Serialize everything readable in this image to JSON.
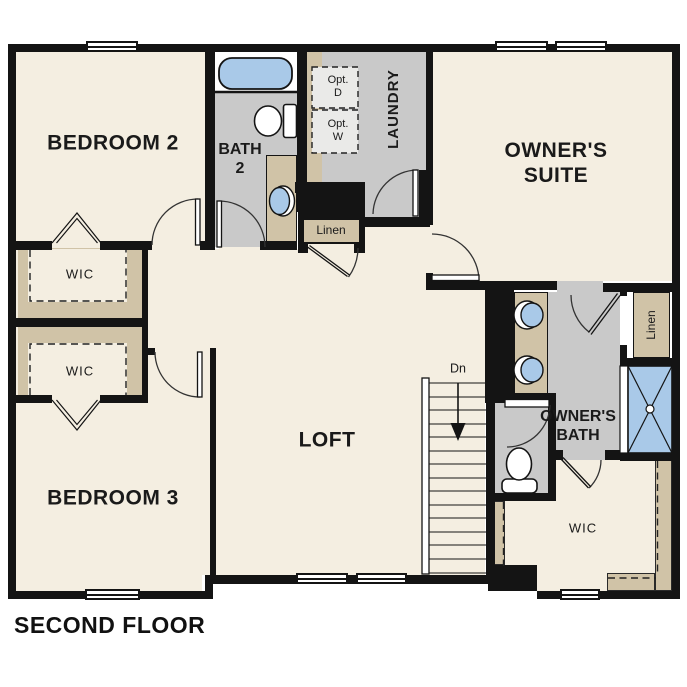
{
  "floorplan": {
    "title": "SECOND FLOOR",
    "labels": {
      "bedroom2": "BEDROOM 2",
      "bedroom3": "BEDROOM 3",
      "bath2_line1": "BATH",
      "bath2_line2": "2",
      "laundry": "LAUNDRY",
      "opt_dryer_line1": "Opt.",
      "opt_dryer_line2": "D",
      "opt_washer_line1": "Opt.",
      "opt_washer_line2": "W",
      "owners_suite_line1": "OWNER'S",
      "owners_suite_line2": "SUITE",
      "owners_bath_line1": "OWNER'S",
      "owners_bath_line2": "BATH",
      "loft": "LOFT",
      "wic": "WIC",
      "linen": "Linen",
      "stairs_down": "Dn"
    },
    "colors": {
      "wall": "#141414",
      "floor_cream": "#f4eee1",
      "floor_gray": "#c9c9c9",
      "cabinet_tan": "#d0c3a7",
      "fixture_blue": "#a9c9e8",
      "text": "#1a1a1a",
      "background": "#ffffff"
    }
  }
}
